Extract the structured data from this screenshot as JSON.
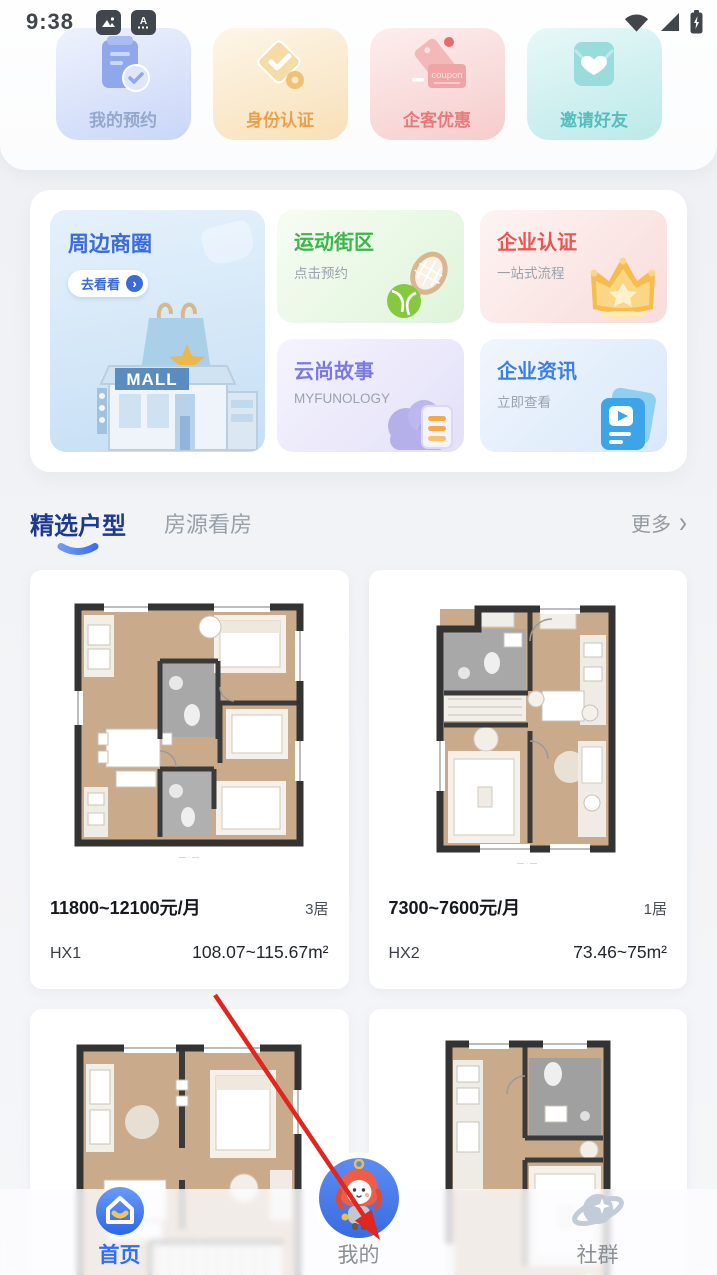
{
  "status_bar": {
    "time": "9:38"
  },
  "quick_actions": {
    "items": [
      {
        "label": "我的预约"
      },
      {
        "label": "身份认证"
      },
      {
        "label": "企客优惠",
        "icon_text": "coupon"
      },
      {
        "label": "邀请好友"
      }
    ]
  },
  "menu": {
    "feature": {
      "title": "周边商圈",
      "button_label": "去看看",
      "button_chevron": "›",
      "building_sign": "MALL"
    },
    "cards": [
      {
        "title": "运动街区",
        "subtitle": "点击预约"
      },
      {
        "title": "企业认证",
        "subtitle": "一站式流程"
      },
      {
        "title": "云尚故事",
        "subtitle": "MYFUNOLOGY"
      },
      {
        "title": "企业资讯",
        "subtitle": "立即查看"
      }
    ]
  },
  "section": {
    "tab_active": "精选户型",
    "tab_inactive": "房源看房",
    "more_label": "更多",
    "more_chevron": "›"
  },
  "listings": [
    {
      "price": "11800~12100元/月",
      "rooms": "3居",
      "code": "HX1",
      "area": "108.07~115.67m²"
    },
    {
      "price": "7300~7600元/月",
      "rooms": "1居",
      "code": "HX2",
      "area": "73.46~75m²"
    }
  ],
  "tabbar": {
    "items": [
      {
        "label": "首页"
      },
      {
        "label": "我的"
      },
      {
        "label": "社群"
      }
    ]
  },
  "colors": {
    "accent_blue": "#2F6EF5",
    "title_navy": "#1E3A8C",
    "feature_blue": "#3A6BD8",
    "green": "#3CB54A",
    "red": "#E85450",
    "purple": "#7B7AE0",
    "info_blue": "#3D7FE0",
    "teal": "#54BDBD",
    "orange": "#E9A04B",
    "coupon_pink": "#E77A7A",
    "arrow_red": "#E0271F"
  }
}
